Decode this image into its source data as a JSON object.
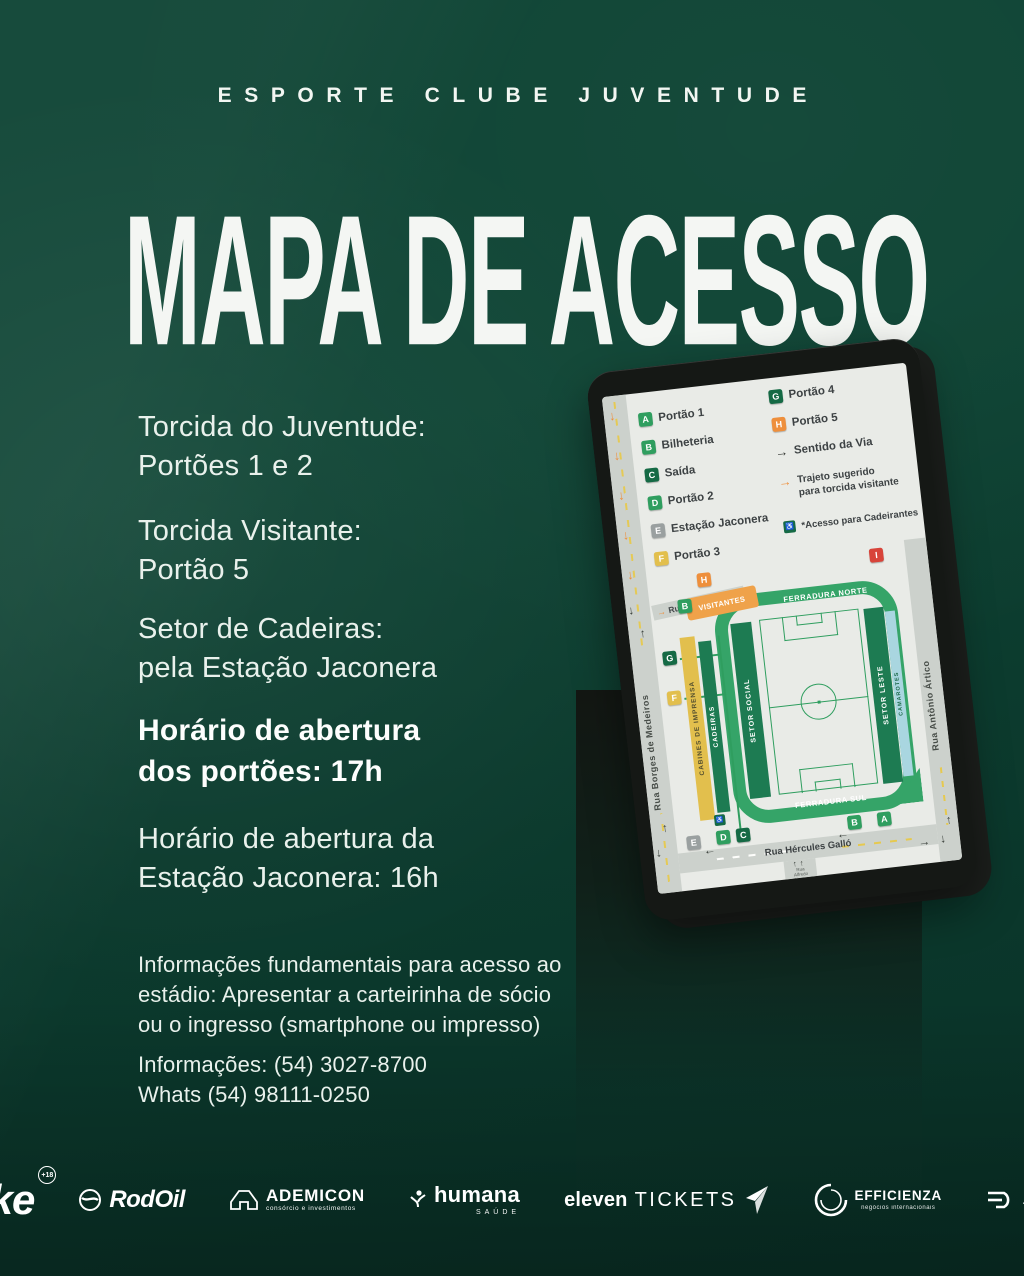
{
  "colors": {
    "bg1": "#0e4434",
    "bg2": "#0c3b2e",
    "bg3": "#093127",
    "bezel": "#151815",
    "screen": "#e9ebe7",
    "street": "#ccd1cc",
    "dashy": "#e6c94f",
    "ink": "#3d4244",
    "mgreen": "#35a468",
    "dgreen": "#156a45",
    "dgreen2": "#1d7b52",
    "bgreen": "#2f9e5f",
    "yellow": "#e2bf4d",
    "orange": "#ee8f3c",
    "vorange": "#efa24a",
    "red": "#d8443a",
    "gray": "#9aa0a0",
    "blue": "#a9d6e0"
  },
  "icons": {
    "arrow_down": "↓",
    "arrow_up": "↑",
    "arrow_right": "→",
    "arrow_left": "←",
    "wheelchair": "♿"
  },
  "header": {
    "club": "ESPORTE CLUBE JUVENTUDE"
  },
  "title": "MAPA DE ACESSO",
  "left": {
    "blocks": [
      {
        "lines": [
          "Torcida do Juventude:",
          "Portões 1 e 2"
        ]
      },
      {
        "lines": [
          "Torcida Visitante:",
          "Portão 5"
        ]
      },
      {
        "lines": [
          "Setor de Cadeiras:",
          "pela Estação Jaconera"
        ]
      },
      {
        "lines": [
          "Horário de abertura",
          "dos portões: 17h"
        ]
      },
      {
        "lines": [
          "Horário de abertura da",
          "Estação Jaconera: 16h"
        ]
      },
      {
        "lines": [
          "Informações fundamentais para acesso ao",
          "estádio: Apresentar a carteirinha de sócio",
          "ou o ingresso (smartphone ou impresso)"
        ]
      },
      {
        "lines": [
          "Informações: (54) 3027-8700",
          "Whats (54) 98111-0250"
        ]
      }
    ]
  },
  "tablet": {
    "legend": {
      "left": [
        {
          "key": "A",
          "label": "Portão 1"
        },
        {
          "key": "B",
          "label": "Bilheteria"
        },
        {
          "key": "C",
          "label": "Saída"
        },
        {
          "key": "D",
          "label": "Portão 2"
        },
        {
          "key": "E",
          "label": "Estação Jaconera"
        },
        {
          "key": "F",
          "label": "Portão 3"
        }
      ],
      "right": [
        {
          "key": "G",
          "label": "Portão 4"
        },
        {
          "key": "H",
          "label": "Portão 5"
        }
      ],
      "sentido": "Sentido da Via",
      "trajeto1": "Trajeto sugerido",
      "trajeto2": "para torcida visitante",
      "acesso": "*Acesso para Cadeirantes"
    },
    "map": {
      "streets": {
        "sao_joao": "Rua São João",
        "borges": "Rua Borges de Medeiros",
        "antonio": "Rua Antônio Ártico",
        "hercules": "Rua Hércules Galló",
        "alfredo1": "Rua",
        "alfredo2": "Alfredo",
        "alfredo3": "Chaves"
      },
      "sectors": {
        "visitantes": "VISITANTES",
        "ferradura_norte": "FERRADURA NORTE",
        "ferradura_sul": "FERRADURA SUL",
        "cabines": "CABINES DE IMPRENSA",
        "cadeiras": "CADEIRAS",
        "setor_social": "SETOR SOCIAL",
        "setor_leste": "SETOR LESTE",
        "camarotes": "CAMAROTES"
      },
      "badges": {
        "h": "H",
        "b_top": "B",
        "i": "I",
        "g": "G",
        "f": "F",
        "e": "E",
        "d": "D",
        "c": "C",
        "b_bottom": "B",
        "a": "A"
      }
    }
  },
  "sponsors": {
    "stake": {
      "name": "Stake",
      "badge": "+18"
    },
    "rodoil": {
      "name": "RodOil"
    },
    "ademicon": {
      "name": "ADEMICON",
      "sub": "consórcio e investimentos"
    },
    "humana": {
      "name": "humana",
      "sub": "SAÚDE"
    },
    "eleven": {
      "name": "eleven",
      "name2": "TICKETS"
    },
    "efficienza": {
      "name": "EFFICIENZA",
      "sub": "negócios internacionais"
    },
    "treze": {
      "name": "19TREZE"
    }
  }
}
